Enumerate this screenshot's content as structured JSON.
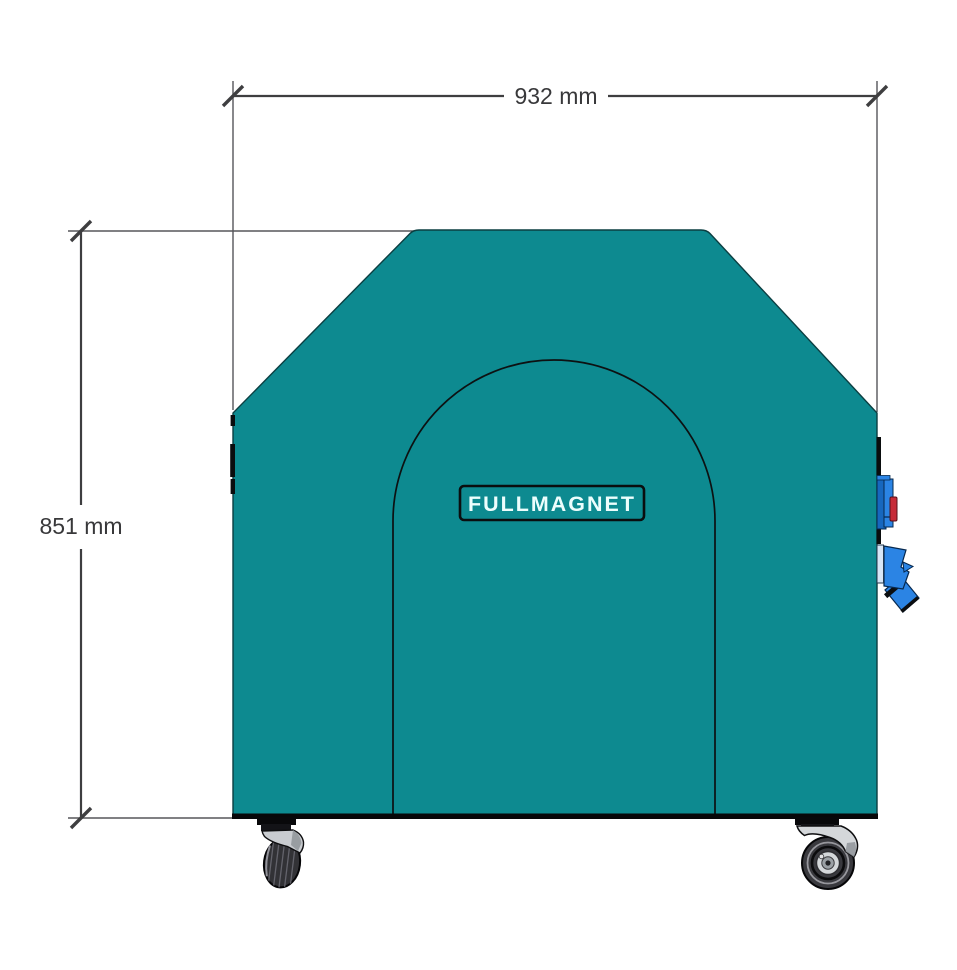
{
  "page": {
    "background": "#FFFFFF"
  },
  "machine": {
    "logo_text": "FULLMAGNET"
  },
  "dimensions": {
    "width": {
      "label": "932 mm",
      "value": 932,
      "unit": "mm"
    },
    "height": {
      "label": "851 mm",
      "value": 851,
      "unit": "mm"
    }
  },
  "colors": {
    "body_teal": "#0D8A90",
    "body_outline": "#0B3E41",
    "bottom_edge_black": "#070709",
    "dimension_line": "#3E3E40",
    "extension_line": "#56565A",
    "dimension_text": "#38383A",
    "logo_text": "#ECFEFD",
    "logo_border": "#0A0E0F",
    "connector_blue": "#2B84E4",
    "connector_blue_dark": "#1767BE",
    "connector_light": "#D8E6F6",
    "switch_red": "#C62B38",
    "caster_gray": "#D4D7DA",
    "caster_gray_dark": "#8F9499",
    "tire_dark": "#323236",
    "hardware_black": "#0A0D0E"
  }
}
